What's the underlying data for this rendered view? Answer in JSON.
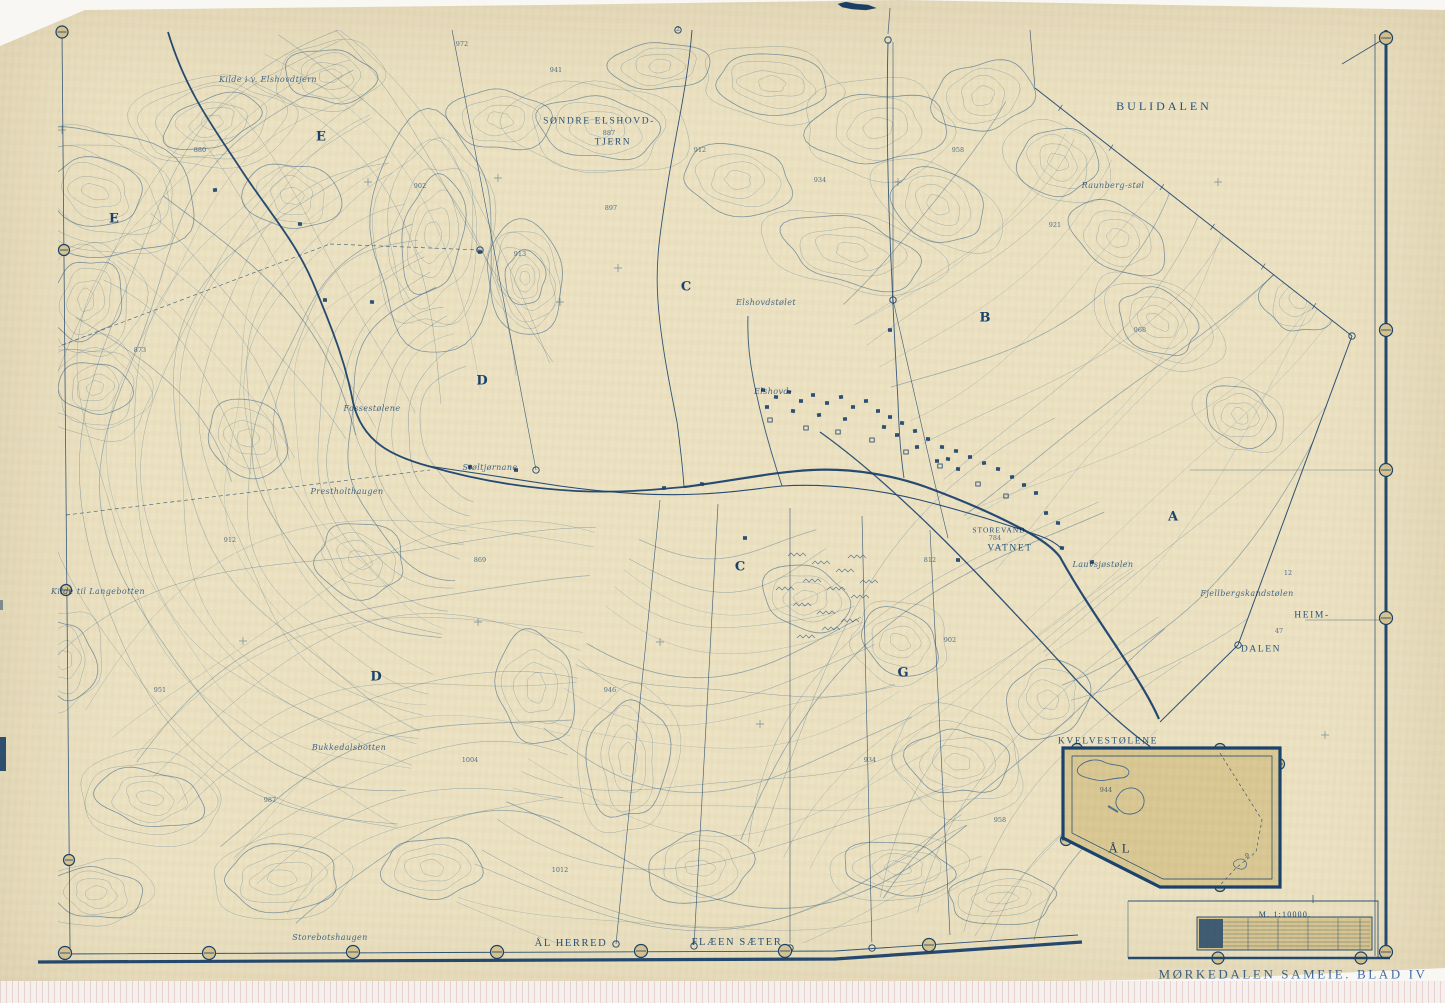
{
  "map": {
    "title": "MØRKEDALEN SAMEIE. BLAD IV",
    "scale_label": "M. 1:10000.",
    "inset": {
      "name": "KVELVESTØLENE",
      "area_label": "ÅL"
    },
    "bottom_labels": {
      "left": "ÅL HERRED",
      "right": "FLÆEN SÆTER"
    },
    "colors": {
      "paper": "#ece2c2",
      "ink": "#3a6cb0",
      "ink_dark": "#1d4b8f",
      "scan_bg": "#f8f7f4"
    },
    "place_labels": [
      {
        "text": "BULIDALEN",
        "x": 1164,
        "y": 106,
        "cls": "caps lg"
      },
      {
        "text": "SØNDRE ELSHOVD-",
        "x": 599,
        "y": 122,
        "cls": "caps sm"
      },
      {
        "text": "TJERN",
        "x": 613,
        "y": 143,
        "cls": "caps sm"
      },
      {
        "text": "STOREVAND",
        "x": 999,
        "y": 530,
        "cls": "caps xs"
      },
      {
        "text": "VATNET",
        "x": 1010,
        "y": 549,
        "cls": "caps sm"
      },
      {
        "text": "HEIM-",
        "x": 1312,
        "y": 616,
        "cls": "caps sm"
      },
      {
        "text": "DALEN",
        "x": 1261,
        "y": 650,
        "cls": "caps sm"
      },
      {
        "text": "Kilde til Langebotten",
        "x": 98,
        "y": 592,
        "cls": "cur"
      },
      {
        "text": "Bukkedalsbotten",
        "x": 349,
        "y": 748,
        "cls": "cur"
      },
      {
        "text": "Storebotshaugen",
        "x": 330,
        "y": 938,
        "cls": "cur"
      },
      {
        "text": "Prestholthaugen",
        "x": 347,
        "y": 492,
        "cls": "cur"
      },
      {
        "text": "Fossestølene",
        "x": 372,
        "y": 409,
        "cls": "cur"
      },
      {
        "text": "Støltjørnane",
        "x": 490,
        "y": 468,
        "cls": "cur"
      },
      {
        "text": "Elshovd-",
        "x": 773,
        "y": 392,
        "cls": "cur"
      },
      {
        "text": "Elshovdstølet",
        "x": 766,
        "y": 303,
        "cls": "cur"
      },
      {
        "text": "Raunberg-støl",
        "x": 1113,
        "y": 186,
        "cls": "cur"
      },
      {
        "text": "Fjellbergskandstølen",
        "x": 1247,
        "y": 594,
        "cls": "cur"
      },
      {
        "text": "Lauvsjøstølen",
        "x": 1103,
        "y": 565,
        "cls": "cur"
      },
      {
        "text": "Kilde i v. Elshovdtjern",
        "x": 268,
        "y": 80,
        "cls": "cur"
      }
    ],
    "parcel_letters": [
      {
        "text": "E",
        "x": 321,
        "y": 137
      },
      {
        "text": "E",
        "x": 114,
        "y": 219
      },
      {
        "text": "C",
        "x": 686,
        "y": 287
      },
      {
        "text": "B",
        "x": 985,
        "y": 318
      },
      {
        "text": "D",
        "x": 482,
        "y": 381
      },
      {
        "text": "C",
        "x": 740,
        "y": 567
      },
      {
        "text": "D",
        "x": 376,
        "y": 677
      },
      {
        "text": "G",
        "x": 903,
        "y": 673
      },
      {
        "text": "A",
        "x": 1173,
        "y": 517
      }
    ],
    "spot_heights": [
      {
        "text": "887",
        "x": 609,
        "y": 133
      },
      {
        "text": "784",
        "x": 995,
        "y": 538
      },
      {
        "text": "12",
        "x": 1288,
        "y": 573
      },
      {
        "text": "47",
        "x": 1279,
        "y": 631
      },
      {
        "text": "2",
        "x": 678,
        "y": 29
      },
      {
        "text": "9",
        "x": 1247,
        "y": 856
      },
      {
        "text": "972",
        "x": 462,
        "y": 44
      },
      {
        "text": "941",
        "x": 556,
        "y": 70
      },
      {
        "text": "902",
        "x": 420,
        "y": 186
      },
      {
        "text": "913",
        "x": 520,
        "y": 254
      },
      {
        "text": "897",
        "x": 611,
        "y": 208
      },
      {
        "text": "912",
        "x": 700,
        "y": 150
      },
      {
        "text": "934",
        "x": 820,
        "y": 180
      },
      {
        "text": "958",
        "x": 958,
        "y": 150
      },
      {
        "text": "921",
        "x": 1055,
        "y": 225
      },
      {
        "text": "968",
        "x": 1140,
        "y": 330
      },
      {
        "text": "880",
        "x": 200,
        "y": 150
      },
      {
        "text": "873",
        "x": 140,
        "y": 350
      },
      {
        "text": "912",
        "x": 230,
        "y": 540
      },
      {
        "text": "951",
        "x": 160,
        "y": 690
      },
      {
        "text": "987",
        "x": 270,
        "y": 800
      },
      {
        "text": "1004",
        "x": 470,
        "y": 760
      },
      {
        "text": "946",
        "x": 610,
        "y": 690
      },
      {
        "text": "902",
        "x": 950,
        "y": 640
      },
      {
        "text": "934",
        "x": 870,
        "y": 760
      },
      {
        "text": "958",
        "x": 1000,
        "y": 820
      },
      {
        "text": "1012",
        "x": 560,
        "y": 870
      },
      {
        "text": "869",
        "x": 480,
        "y": 560
      },
      {
        "text": "812",
        "x": 930,
        "y": 560
      },
      {
        "text": "944",
        "x": 1106,
        "y": 790
      }
    ]
  }
}
